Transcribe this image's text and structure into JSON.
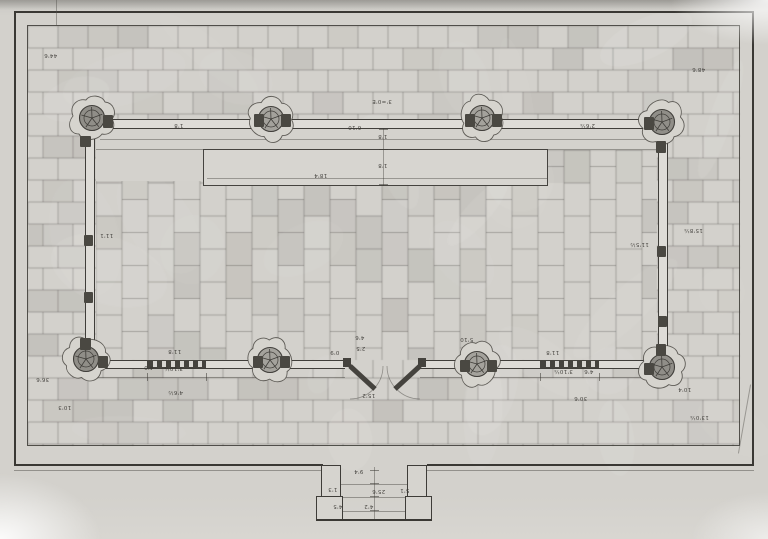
{
  "drawing": {
    "colors": {
      "paper": "#d3d1cc",
      "ink": "#3a3834",
      "hatch_line": "#75736c",
      "wall_fill": "#dedcd7",
      "block_dark": "#4a4842",
      "column_fill": "#a3a19b"
    },
    "annotations": [
      {
        "text": "44'6",
        "x": 44,
        "y": 52
      },
      {
        "text": "48'6",
        "x": 692,
        "y": 66
      },
      {
        "text": "3'=0'E",
        "x": 372,
        "y": 98
      },
      {
        "text": "1'8",
        "x": 174,
        "y": 122
      },
      {
        "text": "6'10",
        "x": 348,
        "y": 124
      },
      {
        "text": "2'6¼",
        "x": 580,
        "y": 122
      },
      {
        "text": "1'8",
        "x": 378,
        "y": 133
      },
      {
        "text": "1'8",
        "x": 378,
        "y": 162
      },
      {
        "text": "18'4",
        "x": 314,
        "y": 172
      },
      {
        "text": "11'1",
        "x": 100,
        "y": 232
      },
      {
        "text": "11'5½",
        "x": 630,
        "y": 241
      },
      {
        "text": "15'8¼",
        "x": 684,
        "y": 227
      },
      {
        "text": "4'6",
        "x": 355,
        "y": 334
      },
      {
        "text": "2'5",
        "x": 356,
        "y": 345
      },
      {
        "text": "0'9",
        "x": 330,
        "y": 349
      },
      {
        "text": "15'2",
        "x": 362,
        "y": 392
      },
      {
        "text": "11'8",
        "x": 168,
        "y": 348
      },
      {
        "text": "4'0",
        "x": 144,
        "y": 364
      },
      {
        "text": "3'10¼",
        "x": 164,
        "y": 365
      },
      {
        "text": "4'6½",
        "x": 168,
        "y": 389
      },
      {
        "text": "36'6",
        "x": 36,
        "y": 376
      },
      {
        "text": "10'3",
        "x": 58,
        "y": 404
      },
      {
        "text": "5'10",
        "x": 460,
        "y": 336
      },
      {
        "text": "11'8",
        "x": 546,
        "y": 349
      },
      {
        "text": "3'10¼",
        "x": 554,
        "y": 368
      },
      {
        "text": "4'6",
        "x": 584,
        "y": 368
      },
      {
        "text": "30'6",
        "x": 574,
        "y": 395
      },
      {
        "text": "10'4",
        "x": 678,
        "y": 386
      },
      {
        "text": "13'0¼",
        "x": 690,
        "y": 414
      },
      {
        "text": "9'4",
        "x": 354,
        "y": 468
      },
      {
        "text": "25'6",
        "x": 372,
        "y": 488
      },
      {
        "text": "1'3",
        "x": 328,
        "y": 486
      },
      {
        "text": "5'1",
        "x": 400,
        "y": 487
      },
      {
        "text": "4'5",
        "x": 333,
        "y": 503
      },
      {
        "text": "4'2",
        "x": 364,
        "y": 503
      }
    ]
  }
}
